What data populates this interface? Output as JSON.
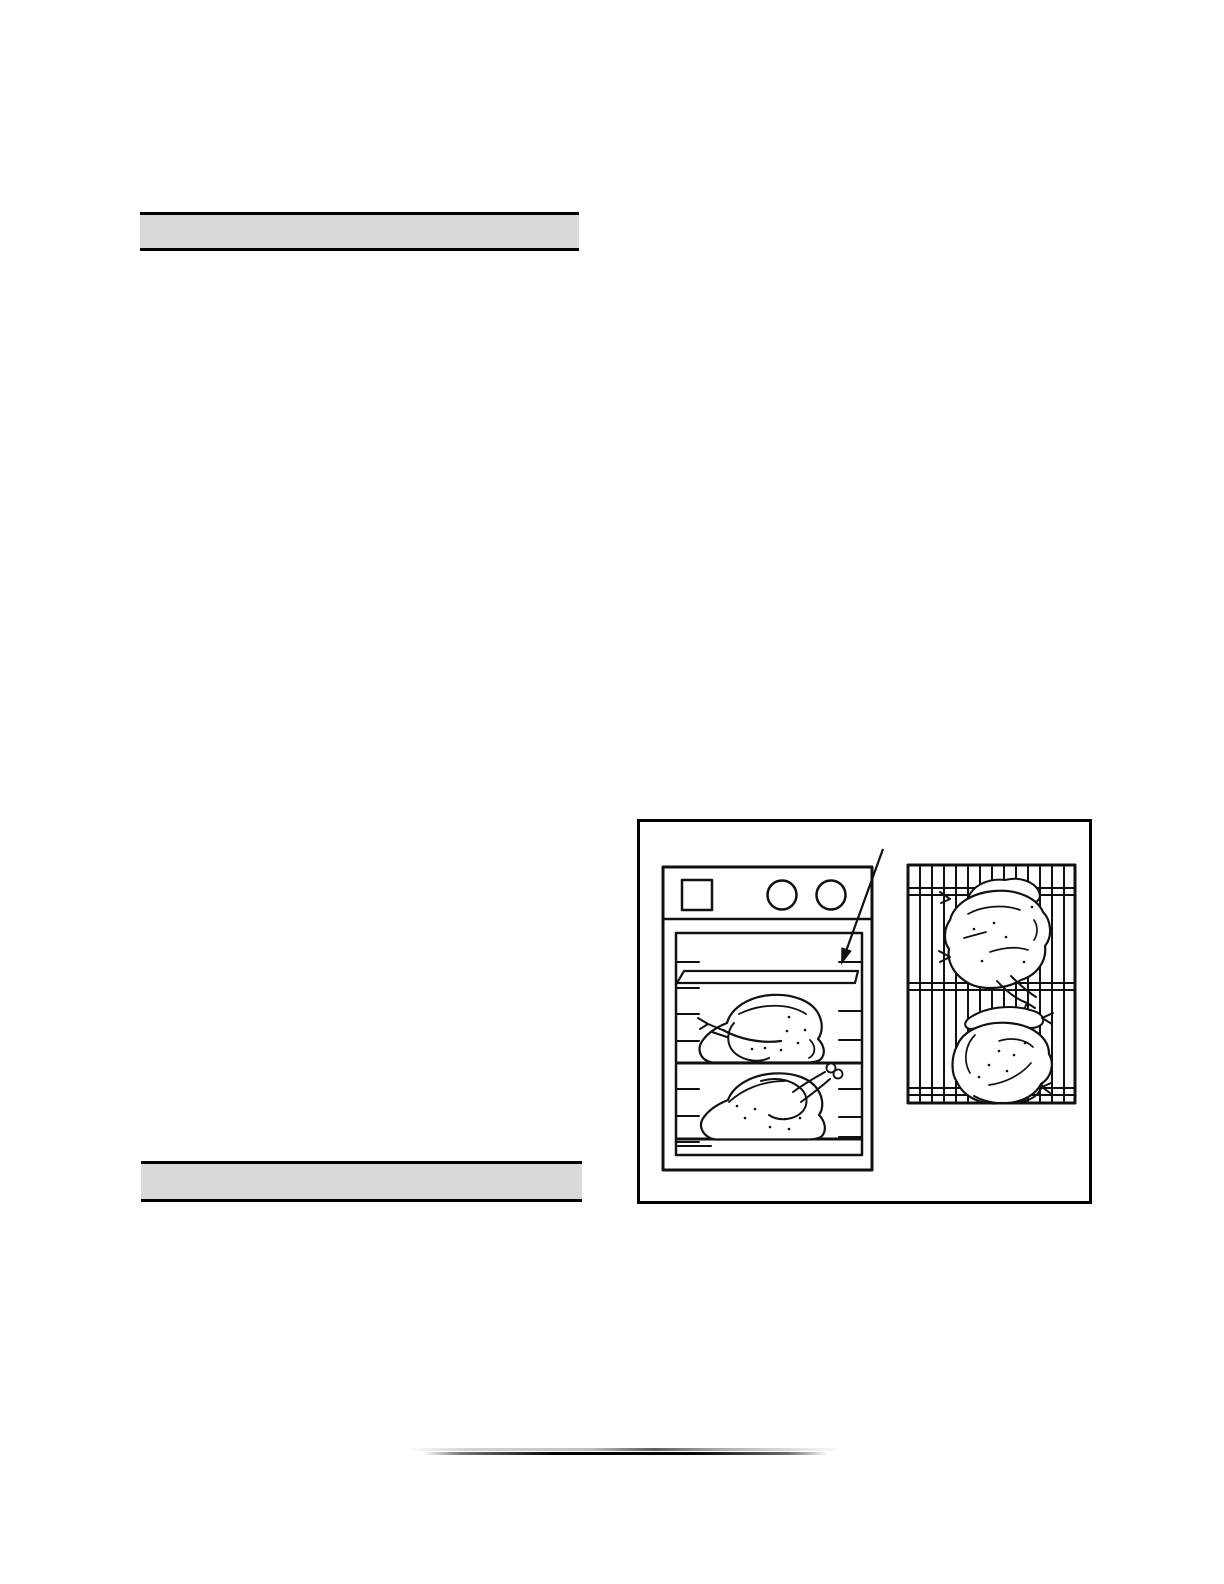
{
  "page": {
    "background_color": "#ffffff",
    "description": "scanned-appliance-manual-page"
  },
  "section_bars": {
    "fill_color": "#d9d9d9",
    "border_color": "#000000",
    "top_label": "",
    "bottom_label": ""
  },
  "figure": {
    "background_color": "#ffffff",
    "border_color": "#000000",
    "line_color": "#111111",
    "oven_panel_label": "oven-front-view-with-two-roast-chickens-on-shelves",
    "shelf_label": "upper-oven-shelf",
    "arrow_label": "arrow-pointing-to-upper-oven-shelf",
    "rack_panel_label": "wire-grill-rack-top-view-with-two-roast-chickens"
  },
  "footer_divider": {
    "upper_line_color": "#8f8f8f",
    "lower_line_color": "#1a1a1a"
  }
}
